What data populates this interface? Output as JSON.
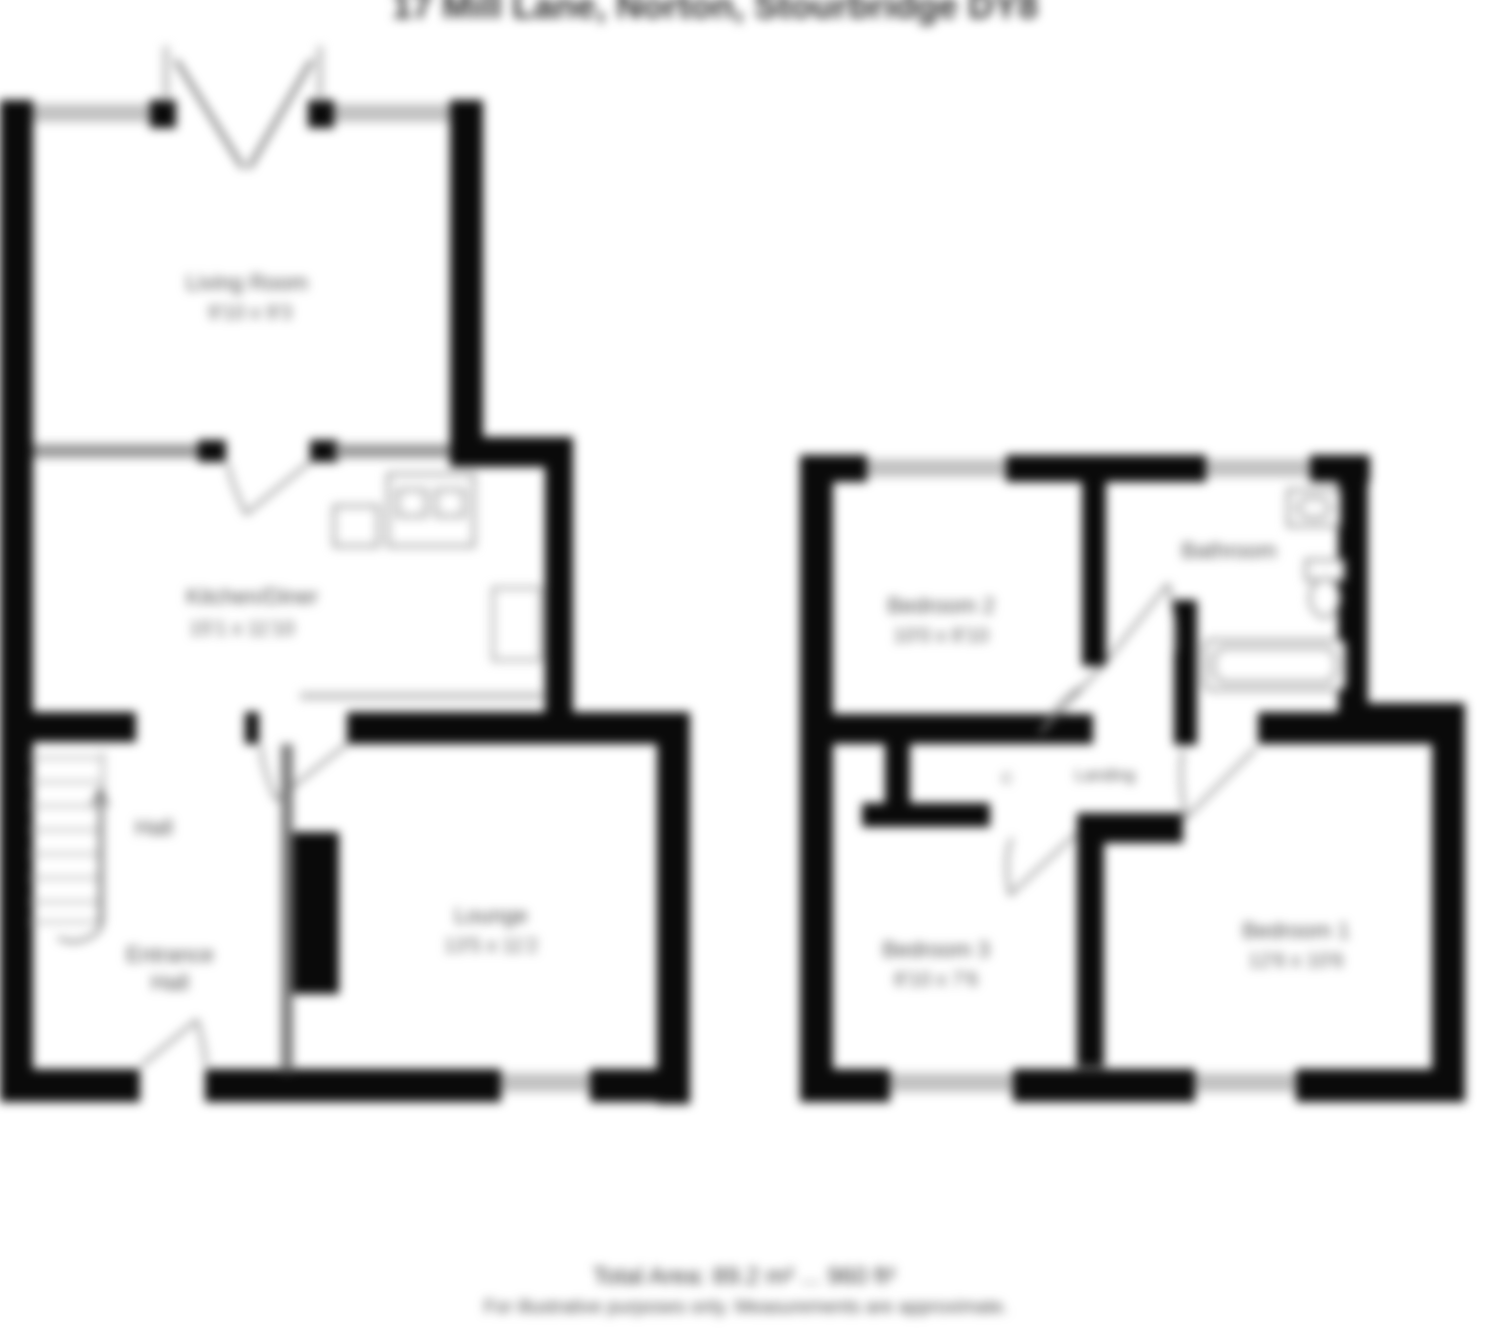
{
  "title": "17 Mill Lane, Norton, Stourbridge DY8",
  "footer": {
    "area_line": "Total Area: 89.2 m² ... 960 ft²",
    "disclaimer": "For illustrative purposes only. Measurements are approximate."
  },
  "colors": {
    "wall": "#0a0a0a",
    "window": "#c2c2c2",
    "thin_wall": "#9a9a9a",
    "label_text": "#4f4f4f",
    "fixture_stroke": "#8f8f8f"
  },
  "ground_floor": {
    "rooms": {
      "living_room": {
        "name": "Living Room",
        "dims": "9'10 x 9'3"
      },
      "kitchen_diner": {
        "name": "Kitchen/Diner",
        "dims": "15'1 x 11'10"
      },
      "lounge": {
        "name": "Lounge",
        "dims": "13'5 x 11'2"
      },
      "hall": {
        "name": "Hall"
      },
      "entrance_hall": {
        "line1": "Entrance",
        "line2": "Hall"
      }
    },
    "features": [
      "french-doors",
      "stairs-up",
      "sink-unit",
      "cooker",
      "radiator",
      "chimney-breast",
      "front-door"
    ]
  },
  "first_floor": {
    "rooms": {
      "bedroom_1": {
        "name": "Bedroom 1",
        "dims": "12'6 x 10'6"
      },
      "bedroom_2": {
        "name": "Bedroom 2",
        "dims": "10'0 x 8'10"
      },
      "bedroom_3": {
        "name": "Bedroom 3",
        "dims": "8'10 x 7'6"
      },
      "bathroom": {
        "name": "Bathroom"
      },
      "landing": {
        "name": "Landing"
      },
      "cupboard": {
        "name": "C"
      }
    },
    "features": [
      "bath",
      "wash-basin",
      "toilet",
      "airing-cupboard"
    ]
  }
}
